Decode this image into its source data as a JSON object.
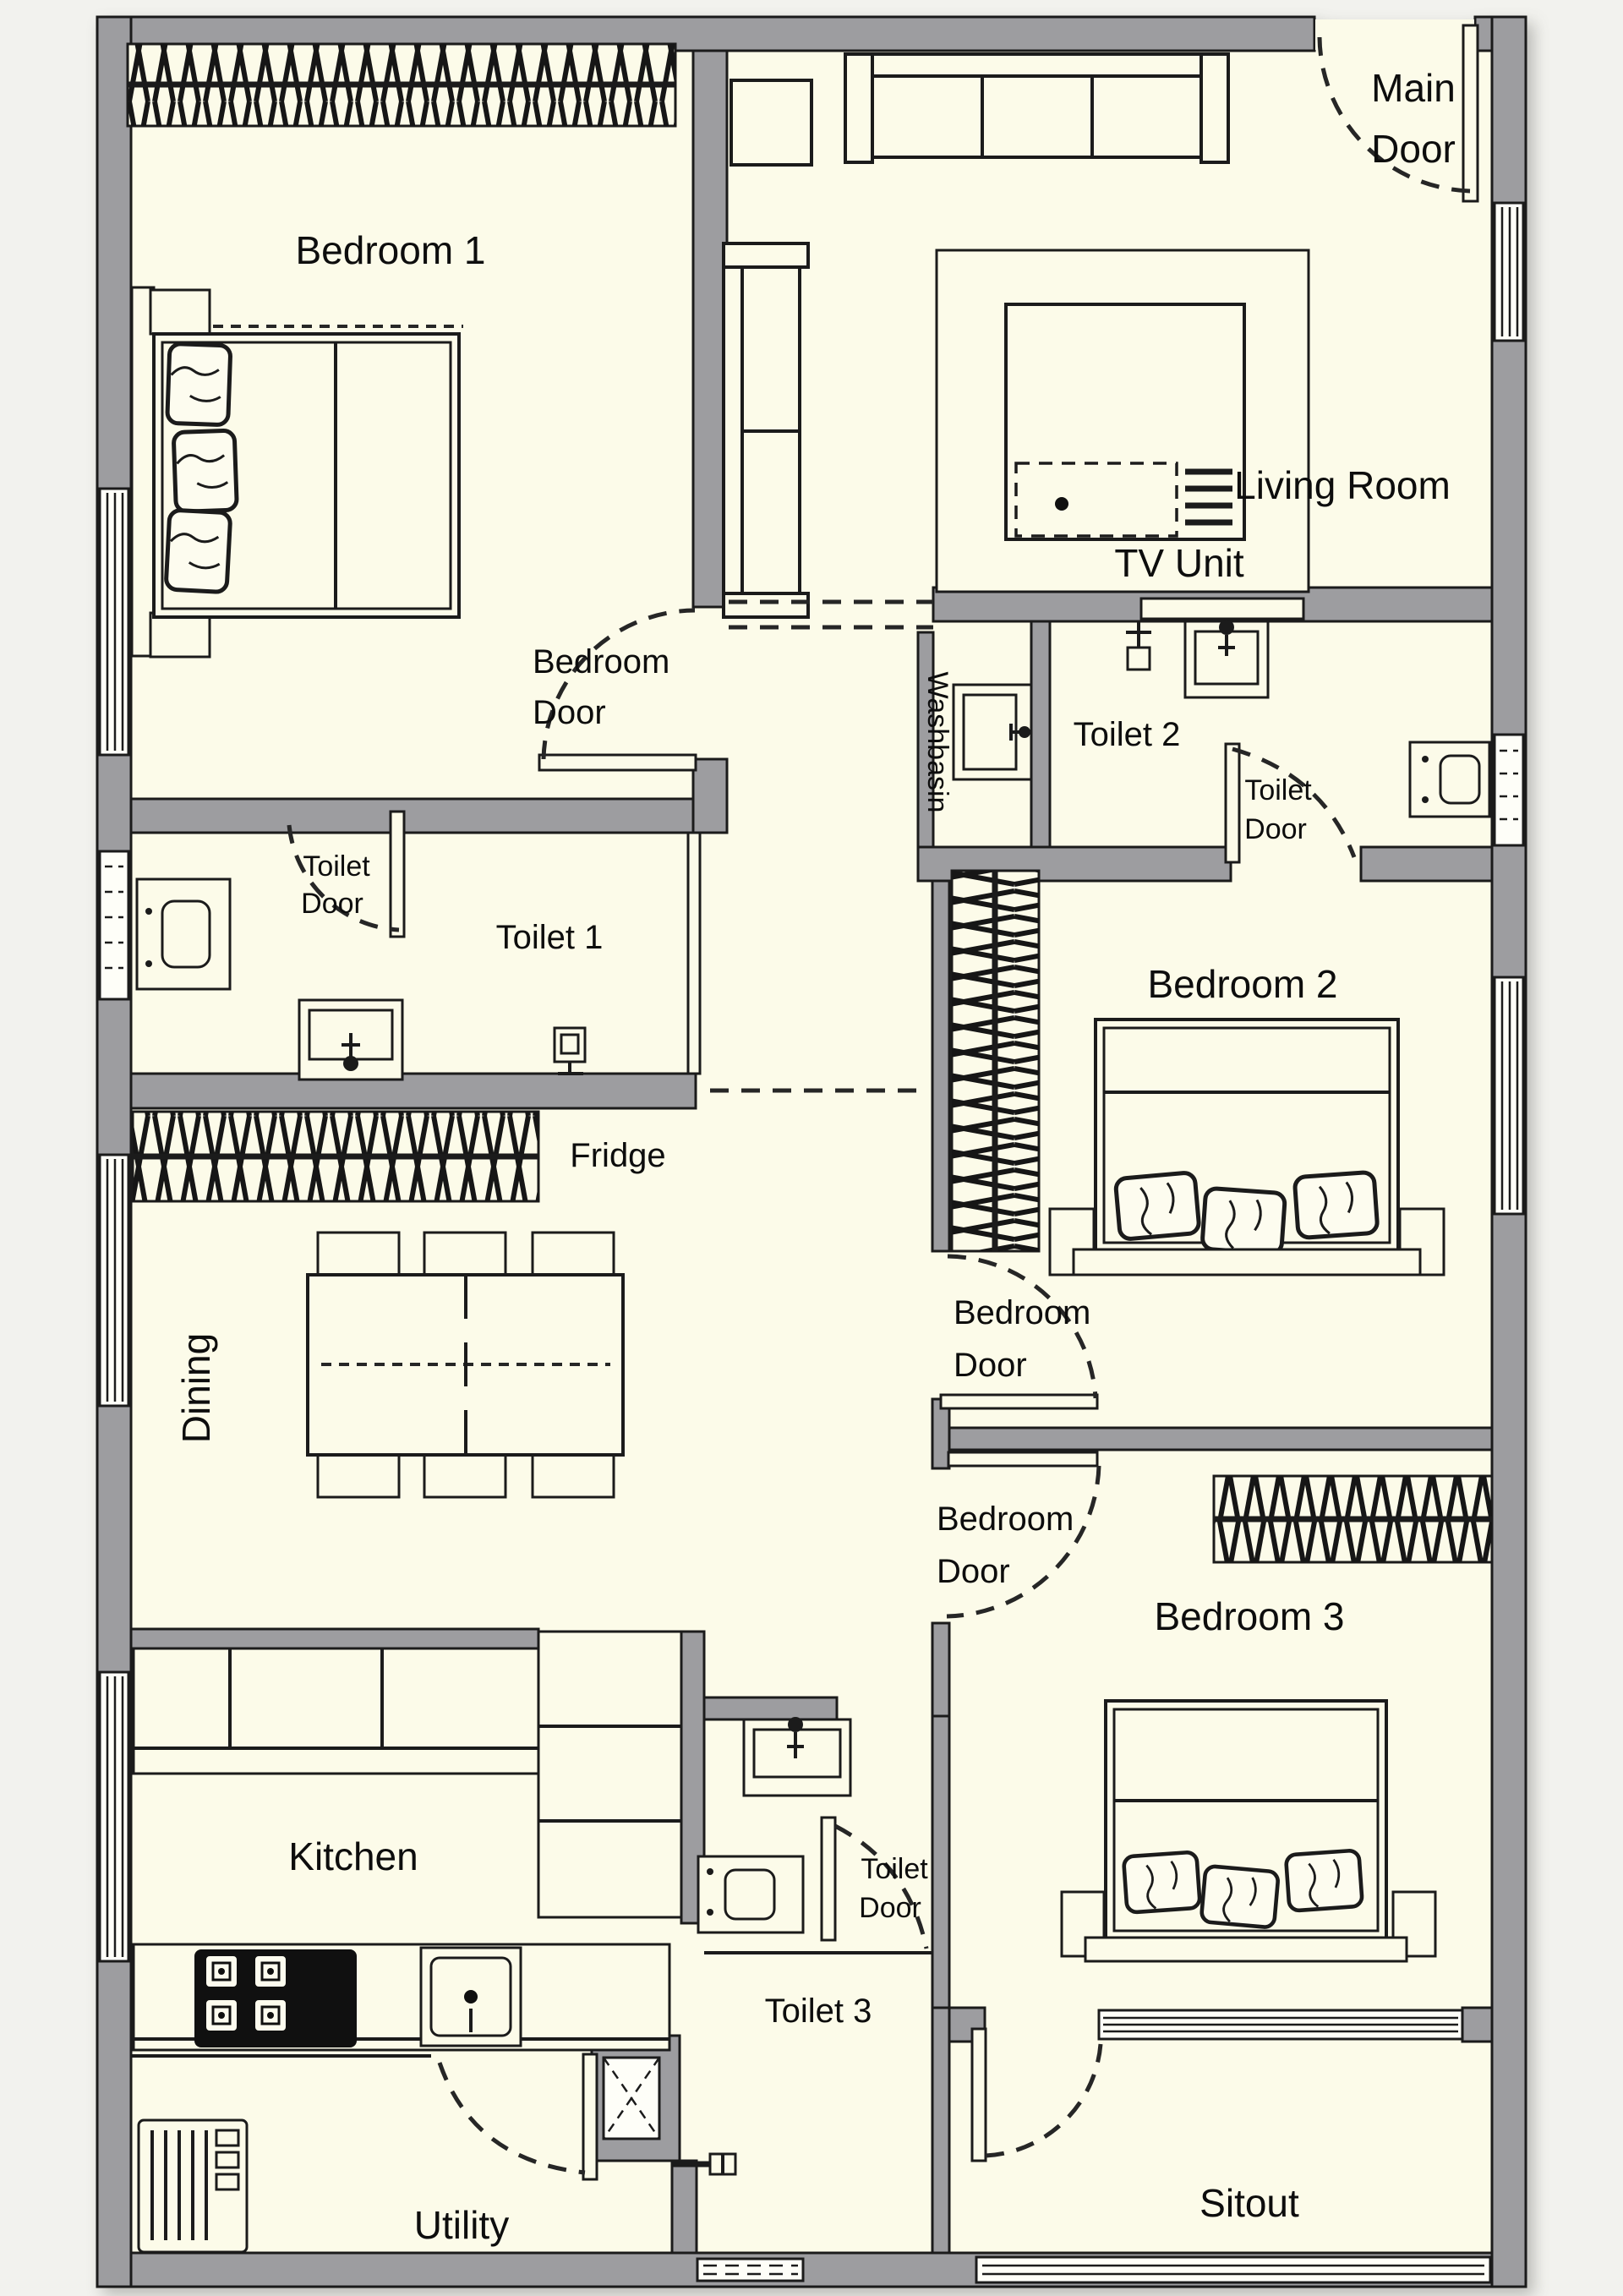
{
  "colors": {
    "page": "#F2F2EE",
    "floor": "#FCFBE9",
    "wall": "#9D9DA0",
    "line": "#1b1b1b"
  },
  "labels": {
    "bedroom1": {
      "text": "Bedroom 1"
    },
    "main_door": {
      "line1": "Main",
      "line2": "Door"
    },
    "living_room": {
      "text": "Living Room"
    },
    "tv_unit": {
      "text": "TV Unit"
    },
    "bedroom1_door": {
      "line1": "Bedroom",
      "line2": "Door"
    },
    "washbasin": {
      "text": "Washbasin"
    },
    "toilet2": {
      "text": "Toilet 2"
    },
    "toilet2_door": {
      "line1": "Toilet",
      "line2": "Door"
    },
    "toilet1": {
      "text": "Toilet 1"
    },
    "toilet1_door": {
      "line1": "Toilet",
      "line2": "Door"
    },
    "bedroom2": {
      "text": "Bedroom 2"
    },
    "fridge": {
      "text": "Fridge"
    },
    "dining": {
      "text": "Dining"
    },
    "bedroom2_door": {
      "line1": "Bedroom",
      "line2": "Door"
    },
    "bedroom3_door": {
      "line1": "Bedroom",
      "line2": "Door"
    },
    "bedroom3": {
      "text": "Bedroom 3"
    },
    "kitchen": {
      "text": "Kitchen"
    },
    "toilet3_door": {
      "line1": "Toilet",
      "line2": "Door"
    },
    "toilet3": {
      "text": "Toilet 3"
    },
    "utility": {
      "text": "Utility"
    },
    "sitout": {
      "text": "Sitout"
    }
  },
  "symbols": {
    "wardrobe-hatch": "criss-cross hatched strip",
    "double-bed": "rect with inner border, fold line, pillows, headboard, bedside tables",
    "pillow": "rounded rect with crease lines",
    "sofa-three-seater": "back band, two armrests, three cushions",
    "sofa-two-seater": "back band, two armrests, two cushions",
    "coffee-table-rug": "nested rects with detail block",
    "tv-unit": "thin rect on wall",
    "dining-table": "rect with dashed centre cross",
    "chair": "small rect",
    "wc": "rect with rounded inner bowl and bolt dots",
    "washbasin": "rect with inner basin and tap flower",
    "shower": "small square with riser and cross arm",
    "stove": "black block with four burners",
    "sink": "rect with inner bowl and drain dot",
    "kitchen-cabinet": "tall shelved rect",
    "washing-machine": "rect with drum slats and knobs",
    "duct-shaft": "box with X cross",
    "tap": "wall spout glyph",
    "door-swing": "leaf rect with dashed quarter arc",
    "window": "white band with parallel lines",
    "louver-vent": "white band with dash rows",
    "railing": "white band with rails"
  }
}
